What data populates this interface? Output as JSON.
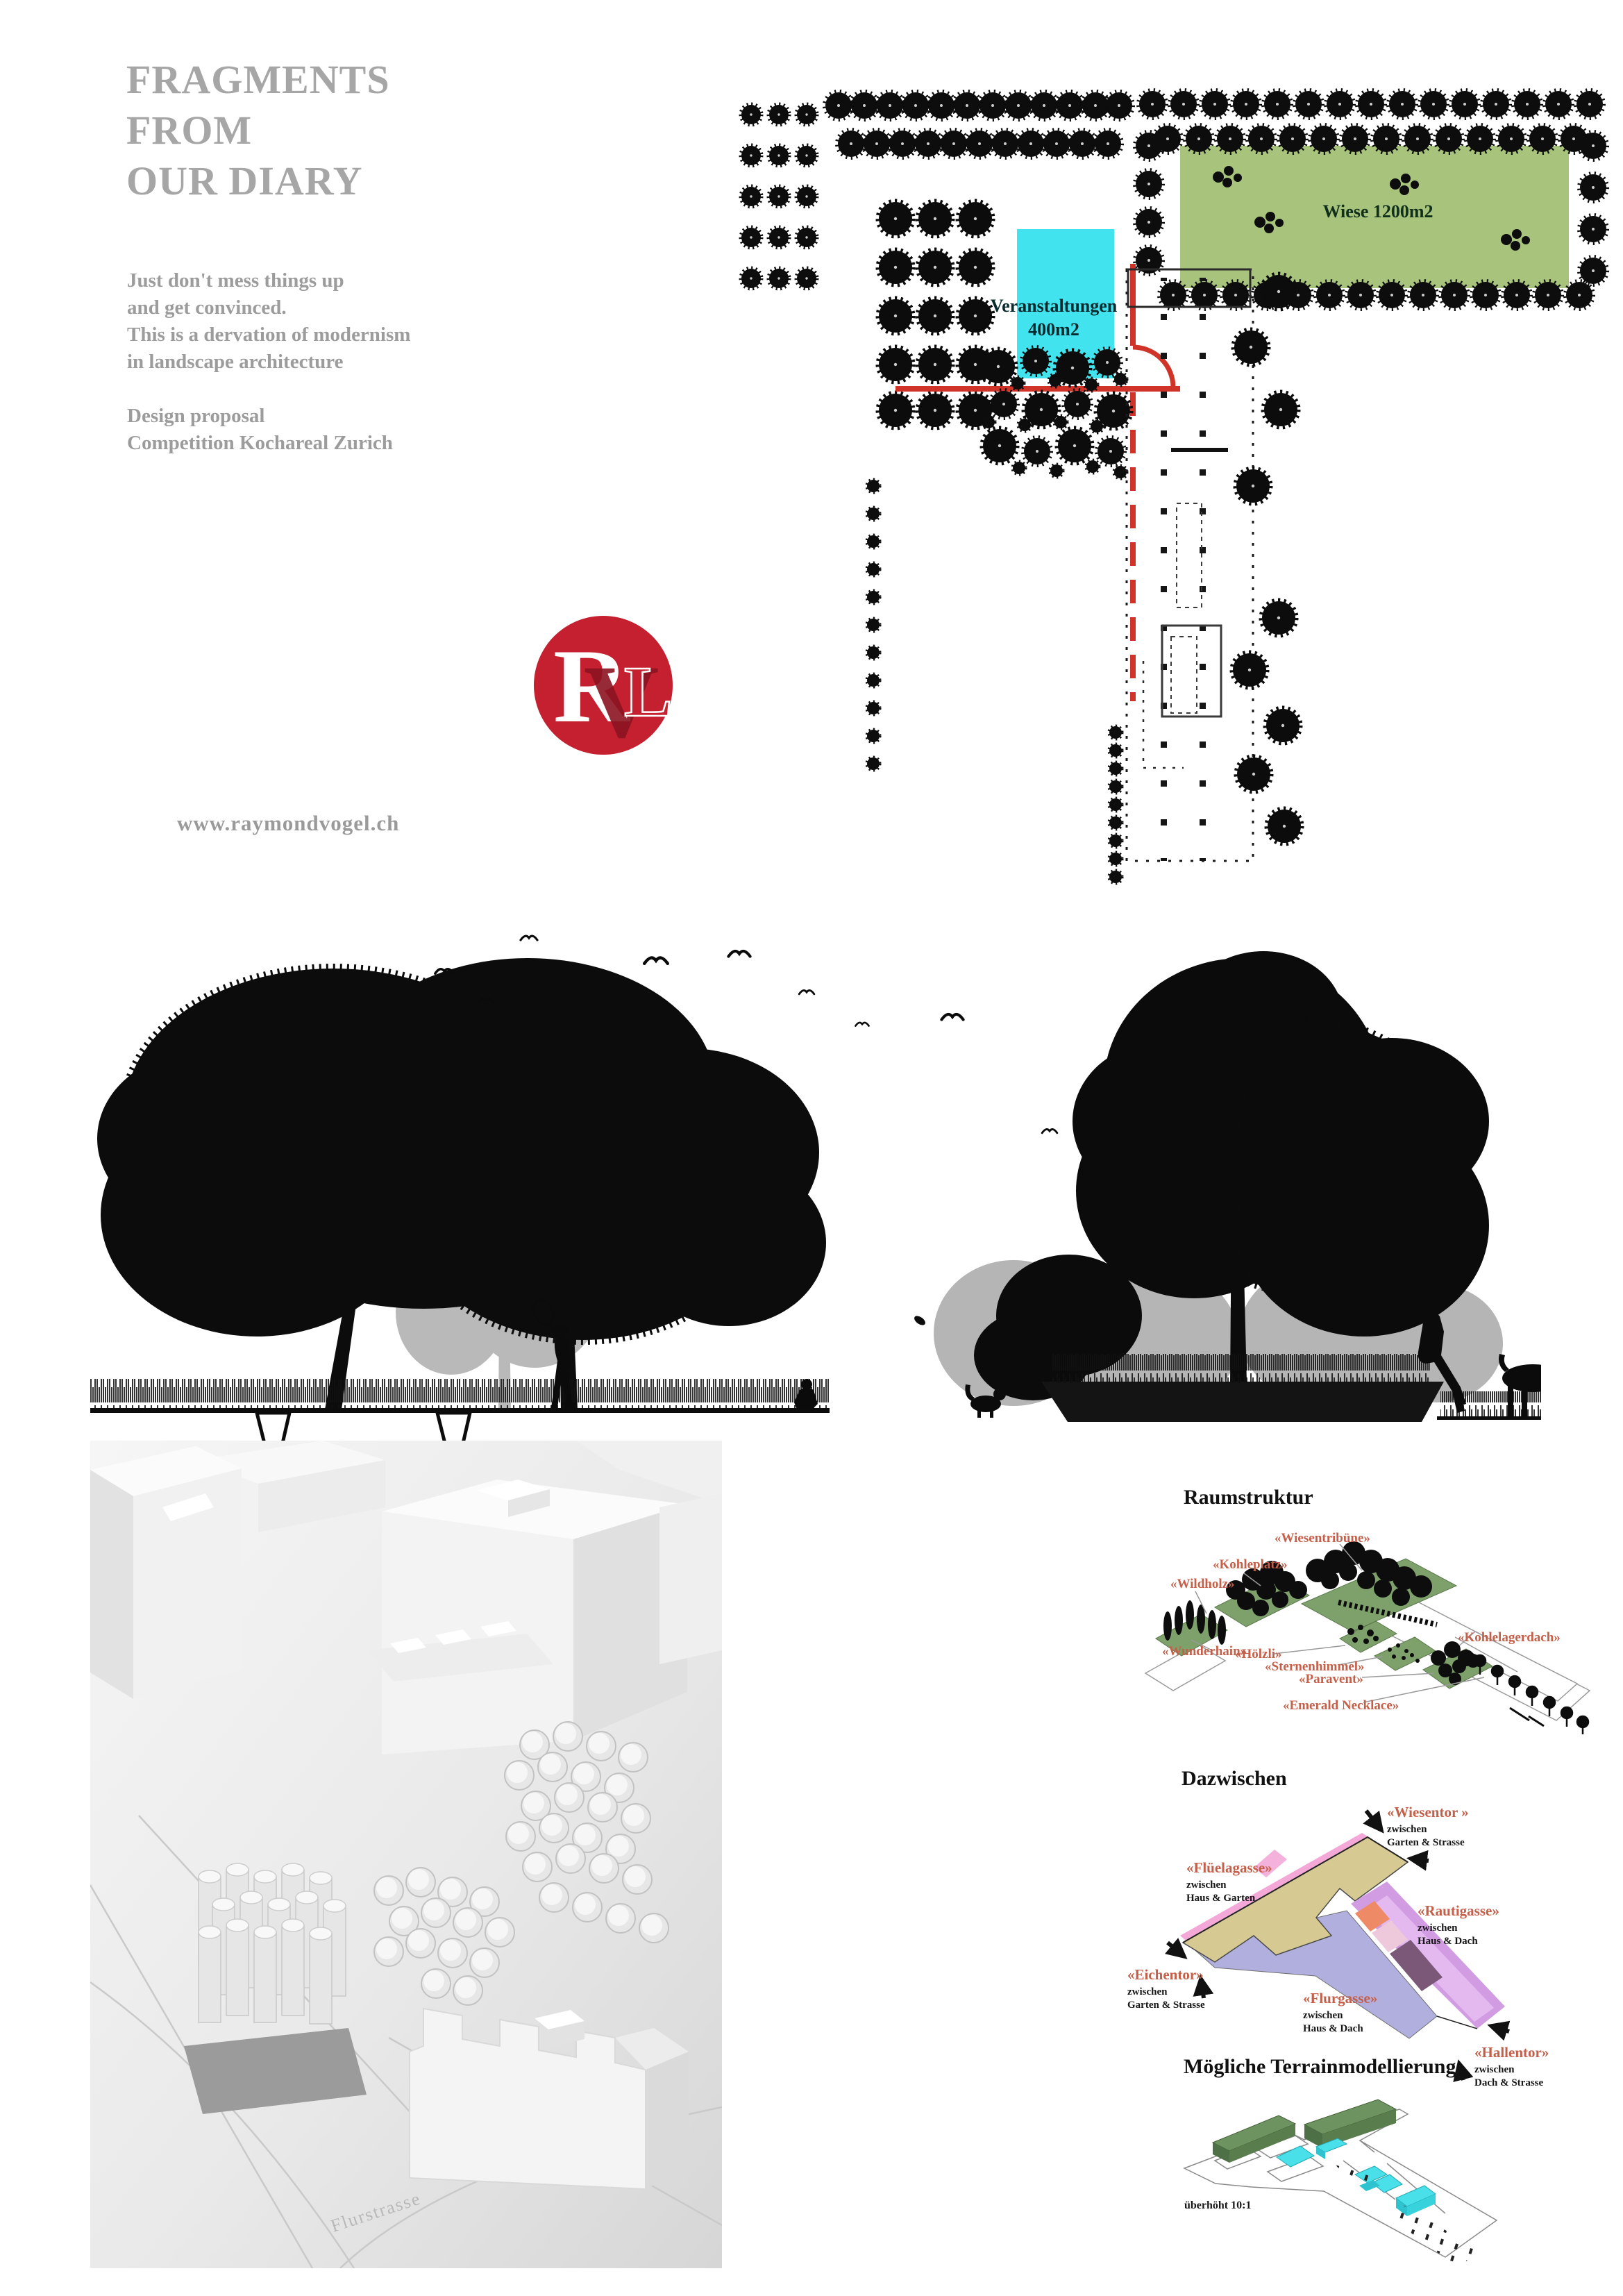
{
  "header": {
    "title_line1": "FRAGMENTS",
    "title_line2": "FROM",
    "title_line3": "OUR DIARY",
    "intro_line1": "Just don't mess things up",
    "intro_line2": "and get convinced.",
    "intro_line3": "This is a dervation of modernism",
    "intro_line4": "in landscape architecture",
    "proposal_line1": "Design proposal",
    "proposal_line2": "Competition Kochareal Zurich",
    "website": "www.raymondvogel.ch",
    "logo_r": "R",
    "logo_v": "V",
    "logo_l": "L"
  },
  "site_plan": {
    "wiese_label": "Wiese 1200m2",
    "event_line1": "Veranstaltungen",
    "event_line2": "400m2"
  },
  "raumstruktur": {
    "title": "Raumstruktur",
    "labels": {
      "wiesentribuene": "«Wiesentribüne»",
      "kohleplatz": "«Kohleplatz»",
      "wildholz": "«Wildholz»",
      "wunderhain": "«Wunderhain»",
      "hoelzli": "«Hölzli»",
      "sternenhimmel": "«Sternenhimmel»",
      "paravent": "«Paravent»",
      "kohlelagerdach": "«Kohlelagerdach»",
      "emerald_necklace": "«Emerald Necklace»"
    }
  },
  "dazwischen": {
    "title": "Dazwischen",
    "gates": [
      {
        "name": "«Wiesentor »",
        "sub1": "zwischen",
        "sub2": "Garten & Strasse"
      },
      {
        "name": "«Flüelagasse»",
        "sub1": "zwischen",
        "sub2": "Haus & Garten"
      },
      {
        "name": "«Rautigasse»",
        "sub1": "zwischen",
        "sub2": "Haus & Dach"
      },
      {
        "name": "«Eichentor»",
        "sub1": "zwischen",
        "sub2": "Garten & Strasse"
      },
      {
        "name": "«Flurgasse»",
        "sub1": "zwischen",
        "sub2": "Haus & Dach"
      },
      {
        "name": "«Hallentor»",
        "sub1": "zwischen",
        "sub2": "Dach & Strasse"
      }
    ]
  },
  "terrain": {
    "title": "Mögliche Terrainmodellierung",
    "note": "überhöht 10:1"
  },
  "model_photo": {
    "street_label": "Flurstrasse"
  },
  "colors": {
    "accent_red": "#c5202f",
    "label_salmon": "#c4604a",
    "plan_green": "#a8c37c",
    "event_cyan": "#41e4ee",
    "street_red": "#d03328",
    "terrain_green": "#5f8456",
    "zone_tan": "#d7c992",
    "zone_pink": "#f3a8d7",
    "zone_purple": "#d29ce2",
    "zone_blue": "#a4a2d8",
    "zone_salmon": "#ef8a66",
    "zone_darkpurple": "#7b5878"
  }
}
